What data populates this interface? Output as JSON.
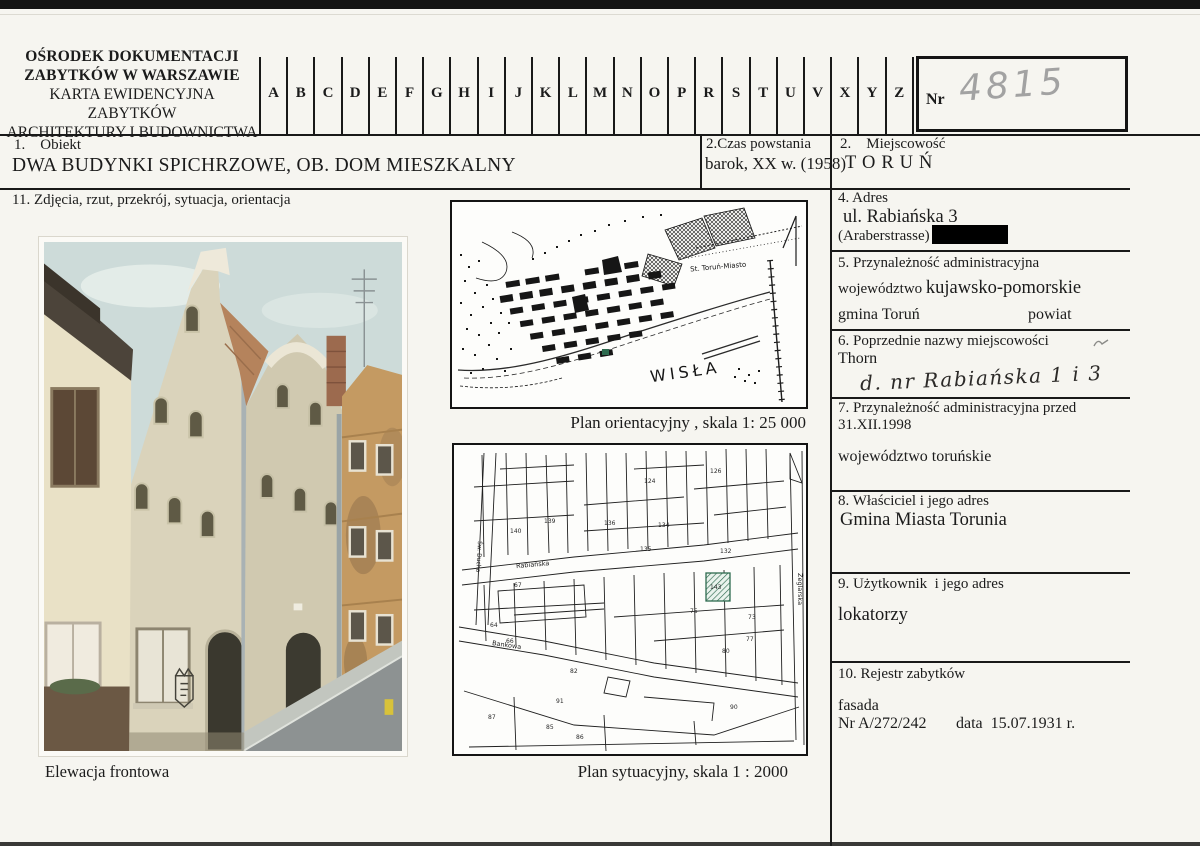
{
  "card": {
    "institution_line1": "OŚRODEK DOKUMENTACJI",
    "institution_line2": "ZABYTKÓW W WARSZAWIE",
    "institution_line3": "KARTA EWIDENCYJNA ZABYTKÓW",
    "institution_line4": "ARCHITEKTURY I BUDOWNICTWA",
    "alphabet": [
      "A",
      "B",
      "C",
      "D",
      "E",
      "F",
      "G",
      "H",
      "I",
      "J",
      "K",
      "L",
      "M",
      "N",
      "O",
      "P",
      "R",
      "S",
      "T",
      "U",
      "V",
      "X",
      "Y",
      "Z"
    ],
    "nr_label": "Nr",
    "nr_value": "4815"
  },
  "fields": {
    "obiekt_label": "1.    Obiekt",
    "obiekt_value": "DWA BUDYNKI SPICHRZOWE, OB. DOM  MIESZKALNY",
    "czas_label": "2.Czas powstania",
    "czas_value": "barok, XX w. (1958)",
    "miejscowosc_label": "2.    Miejscowość",
    "miejscowosc_value": "TORUŃ",
    "adres_label": "4. Adres",
    "adres_line1": "ul. Rabiańska 3",
    "adres_line2": "(Araberstrasse)",
    "admin_label": "5. Przynależność administracyjna",
    "admin_woj_label": "województwo ",
    "admin_woj_value": "kujawsko-pomorskie",
    "admin_gmina": "gmina Toruń",
    "admin_powiat": "powiat",
    "poprzednie_label": "6. Poprzednie nazwy miejscowości",
    "poprzednie_value": "Thorn",
    "poprzednie_handwritten": "d. nr Rabiańska 1 i 3",
    "przed_label_line1": "7. Przynależność administracyjna przed",
    "przed_label_line2": "31.XII.1998",
    "przed_value": "województwo toruńskie",
    "wlasciciel_label": "8. Właściciel i jego adres",
    "wlasciciel_value": "Gmina Miasta Torunia",
    "uzytkownik_label": "9. Użytkownik  i jego adres",
    "uzytkownik_value": "lokatorzy",
    "rejestr_label": "10. Rejestr zabytków",
    "rejestr_line1": "fasada",
    "rejestr_nr": "Nr A/272/242",
    "rejestr_data": "data  15.07.1931 r.",
    "media_label": "11. Zdjęcia, rzut, przekrój, sytuacja, orientacja"
  },
  "photo": {
    "caption": "Elewacja frontowa"
  },
  "maps": {
    "orient_caption": "Plan orientacyjny , skala  1: 25 000",
    "orient_river": "WISŁA",
    "orient_station": "St. Toruń-Miasto",
    "syt_caption": "Plan  sytuacyjny, skala  1 :  2000",
    "street_rabianska": "Rabiańska",
    "street_bankowa": "Bankowa",
    "street_zeglarska": "Żeglarska",
    "street_ducha": "Św. Ducha",
    "parcel_numbers": [
      "124",
      "126",
      "139",
      "140",
      "132",
      "135",
      "136",
      "134",
      "143",
      "67",
      "64",
      "66",
      "75",
      "73",
      "77",
      "80",
      "82",
      "91",
      "90",
      "87",
      "85",
      "86"
    ]
  },
  "colors": {
    "paper": "#f6f5f0",
    "ink": "#1b1b1b",
    "pencil": "#a2a2a2",
    "highlight_green": "#2e6b4f",
    "redaction": "#000000"
  }
}
